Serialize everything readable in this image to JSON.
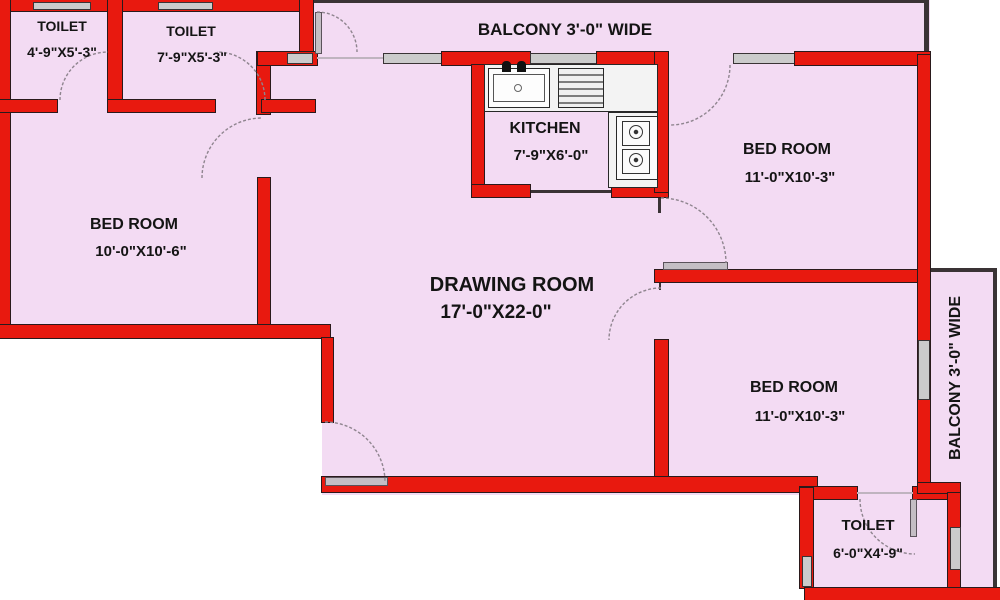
{
  "title": "2BHK-style apartment floor plan",
  "rooms": [
    {
      "name": "TOILET",
      "dims": "4'-9\"X5'-3\""
    },
    {
      "name": "TOILET",
      "dims": "7'-9\"X5'-3\""
    },
    {
      "name": "BALCONY 3'-0\" WIDE",
      "dims": ""
    },
    {
      "name": "KITCHEN",
      "dims": "7'-9\"X6'-0\""
    },
    {
      "name": "BED ROOM",
      "dims": "11'-0\"X10'-3\""
    },
    {
      "name": "BED ROOM",
      "dims": "10'-0\"X10'-6\""
    },
    {
      "name": "DRAWING ROOM",
      "dims": "17'-0\"X22-0\""
    },
    {
      "name": "BED ROOM",
      "dims": "11'-0\"X10'-3\""
    },
    {
      "name": "BALCONY 3'-0\" WIDE",
      "dims": ""
    },
    {
      "name": "TOILET",
      "dims": "6'-0\"X4'-9\""
    }
  ],
  "colors": {
    "wall": "#e8190f",
    "wall_outline": "#2a1a1c",
    "room_fill": "#f3dbf3",
    "window": "#cbcbcb",
    "counter": "#f3f3f3",
    "text": "#141414",
    "door_arc": "#8f858f",
    "background": "#ffffff"
  }
}
